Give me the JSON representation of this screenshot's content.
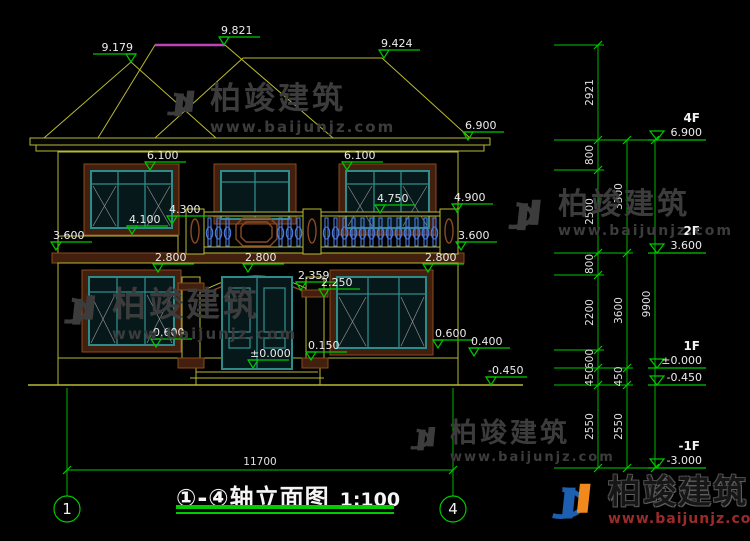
{
  "title": {
    "range": "①-④",
    "name": "轴立面图",
    "scale": "1:100"
  },
  "watermark": {
    "brand": "柏竣建筑",
    "url": "www.baijunjz.com"
  },
  "drawing": {
    "background": "#000000",
    "line_colors": {
      "cad_yellow": "#b9b932",
      "dim_green": "#00c800",
      "trim_brown": "#8a4a22",
      "window_teal": "#2f8a8a",
      "baluster_blue": "#4d7de0",
      "ridge_magenta": "#bb44bb"
    },
    "elevation_markers": [
      {
        "value": "9.179",
        "x": 131,
        "y": 62,
        "d": -1
      },
      {
        "value": "9.821",
        "x": 224,
        "y": 45,
        "d": 1
      },
      {
        "value": "9.424",
        "x": 384,
        "y": 58,
        "d": 1
      },
      {
        "value": "6.900",
        "x": 468,
        "y": 140,
        "d": 1
      },
      {
        "value": "6.100",
        "x": 150,
        "y": 170,
        "d": 1
      },
      {
        "value": "6.100",
        "x": 347,
        "y": 170,
        "d": 1
      },
      {
        "value": "4.900",
        "x": 457,
        "y": 212,
        "d": 1
      },
      {
        "value": "4.750",
        "x": 380,
        "y": 213,
        "d": 1
      },
      {
        "value": "4.300",
        "x": 172,
        "y": 224,
        "d": 1
      },
      {
        "value": "4.100",
        "x": 132,
        "y": 234,
        "d": 1
      },
      {
        "value": "3.600",
        "x": 56,
        "y": 250,
        "d": 1
      },
      {
        "value": "3.600",
        "x": 461,
        "y": 250,
        "d": 1
      },
      {
        "value": "2.800",
        "x": 158,
        "y": 272,
        "d": 1
      },
      {
        "value": "2.800",
        "x": 248,
        "y": 272,
        "d": 1
      },
      {
        "value": "2.800",
        "x": 428,
        "y": 272,
        "d": 1
      },
      {
        "value": "2.359",
        "x": 301,
        "y": 290,
        "d": 1
      },
      {
        "value": "2.250",
        "x": 324,
        "y": 297,
        "d": 1
      },
      {
        "value": "0.600",
        "x": 156,
        "y": 347,
        "d": 1
      },
      {
        "value": "0.600",
        "x": 438,
        "y": 348,
        "d": 1
      },
      {
        "value": "0.400",
        "x": 474,
        "y": 356,
        "d": 1
      },
      {
        "value": "0.150",
        "x": 311,
        "y": 360,
        "d": 1
      },
      {
        "value": "±0.000",
        "x": 253,
        "y": 368,
        "d": 1
      },
      {
        "value": "-0.450",
        "x": 491,
        "y": 385,
        "d": 1
      }
    ],
    "dim_chains": [
      {
        "x": 598,
        "ys": [
          45,
          140,
          170,
          253,
          275,
          350,
          368,
          385,
          468
        ],
        "labels": [
          "2921",
          "800",
          "2500",
          "800",
          "2200",
          "600",
          "450",
          "2550"
        ]
      },
      {
        "x": 627,
        "ys": [
          140,
          253,
          368,
          385,
          468
        ],
        "labels": [
          "3300",
          "3600",
          "450",
          "2550"
        ]
      },
      {
        "x": 655,
        "ys": [
          140,
          468
        ],
        "labels": [
          "9900"
        ]
      }
    ],
    "floor_markers": [
      {
        "floor": "4F",
        "value": "6.900",
        "y": 140
      },
      {
        "floor": "2F",
        "value": "3.600",
        "y": 253
      },
      {
        "floor": "1F",
        "value": "±0.000",
        "y": 368
      },
      {
        "floor": "",
        "value": "-0.450",
        "y": 385
      },
      {
        "floor": "-1F",
        "value": "-3.000",
        "y": 468
      }
    ],
    "baluster_runs": [
      [
        206,
        236
      ],
      [
        277,
        301
      ],
      [
        323,
        438
      ]
    ],
    "bottom_dimension": {
      "value": "11700"
    },
    "axis_bubbles": {
      "left": "1",
      "right": "4"
    }
  }
}
